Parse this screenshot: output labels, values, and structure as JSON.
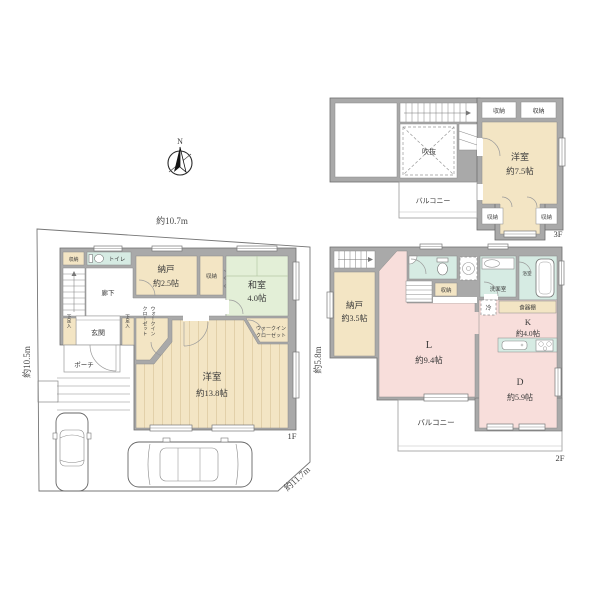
{
  "colors": {
    "wall_gray": "#a9a9a9",
    "wood_beige": "#f3e5c4",
    "tatami_green": "#e3efd7",
    "wet_area_teal": "#d6ebe3",
    "ldk_pink": "#f8dedb",
    "background": "#ffffff"
  },
  "compass": {
    "north": "N"
  },
  "shared": {
    "storage": "収納",
    "balcony": "バルコニー",
    "wic_line1": "ウォークイン",
    "wic_line2": "クローゼット",
    "shoe": "下足入"
  },
  "floor1": {
    "label": "1F",
    "dims": {
      "top": "約10.7m",
      "left": "約10.5m",
      "right": "約5.8m",
      "diagonal": "約11.7m"
    },
    "toilet": "トイレ",
    "hallway": "廊下",
    "entrance": "玄関",
    "porch": "ポーチ",
    "nando": "納戸",
    "nando_size": "約2.5帖",
    "washitsu": "和室",
    "washitsu_size": "4.0帖",
    "yoshitsu": "洋室",
    "yoshitsu_size": "約13.8帖"
  },
  "floor2": {
    "label": "2F",
    "nando": "納戸",
    "nando_size": "約3.5帖",
    "living": "L",
    "living_size": "約9.4帖",
    "dining": "D",
    "dining_size": "約5.9帖",
    "kitchen": "K",
    "kitchen_size": "約4.0帖",
    "washroom": "洗面室",
    "bathroom": "浴室",
    "cupboard": "食器棚",
    "fridge": "冷"
  },
  "floor3": {
    "label": "3F",
    "yoshitsu": "洋室",
    "yoshitsu_size": "約7.5帖",
    "void": "吹抜"
  }
}
